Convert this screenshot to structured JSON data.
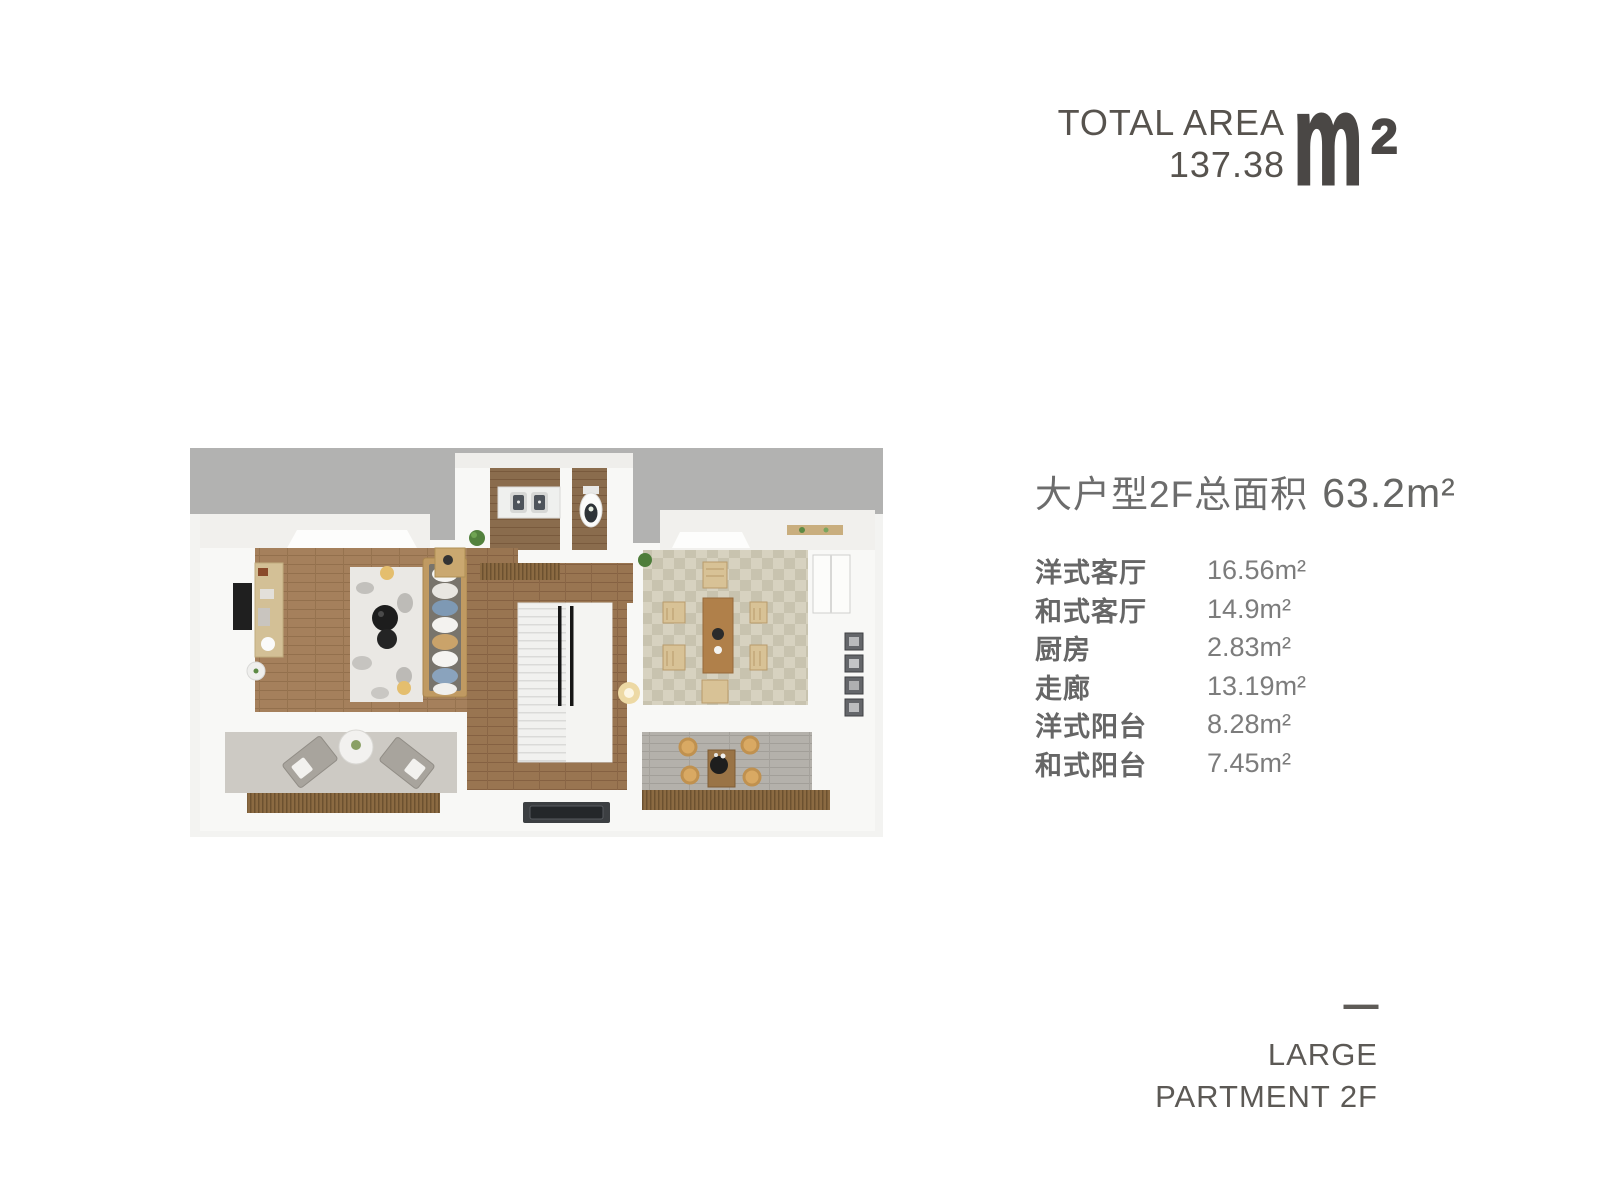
{
  "total_area_badge": {
    "label": "TOTAL AREA",
    "value": "137.38",
    "unit_letter": "m",
    "unit_sup": "2"
  },
  "unit_info": {
    "title": "大户型2F总面积",
    "area_value": "63.2",
    "area_unit": "m²"
  },
  "rooms": [
    {
      "label": "洋式客厅",
      "area": "16.56m²"
    },
    {
      "label": "和式客厅",
      "area": "14.9m²"
    },
    {
      "label": "厨房",
      "area": "2.83m²"
    },
    {
      "label": "走廊",
      "area": "13.19m²"
    },
    {
      "label": "洋式阳台",
      "area": "8.28m²"
    },
    {
      "label": "和式阳台",
      "area": "7.45m²"
    }
  ],
  "footer": {
    "dash": "—",
    "line1": "LARGE",
    "line2": "PARTMENT 2F"
  },
  "colors": {
    "text_dark": "#57534e",
    "text_gray": "#6c6c6c",
    "logo": "#4a4745",
    "backdrop_gray": "#b2b2b1",
    "wall_white": "#f8f8f6",
    "wood_living": "#a5805c",
    "wood_corridor": "#997551",
    "tatami_light": "#d7d2c0",
    "tatami_dark": "#c8c3af",
    "deck_wood": "#8b6a42",
    "accent_cushion": "#d9a963"
  }
}
